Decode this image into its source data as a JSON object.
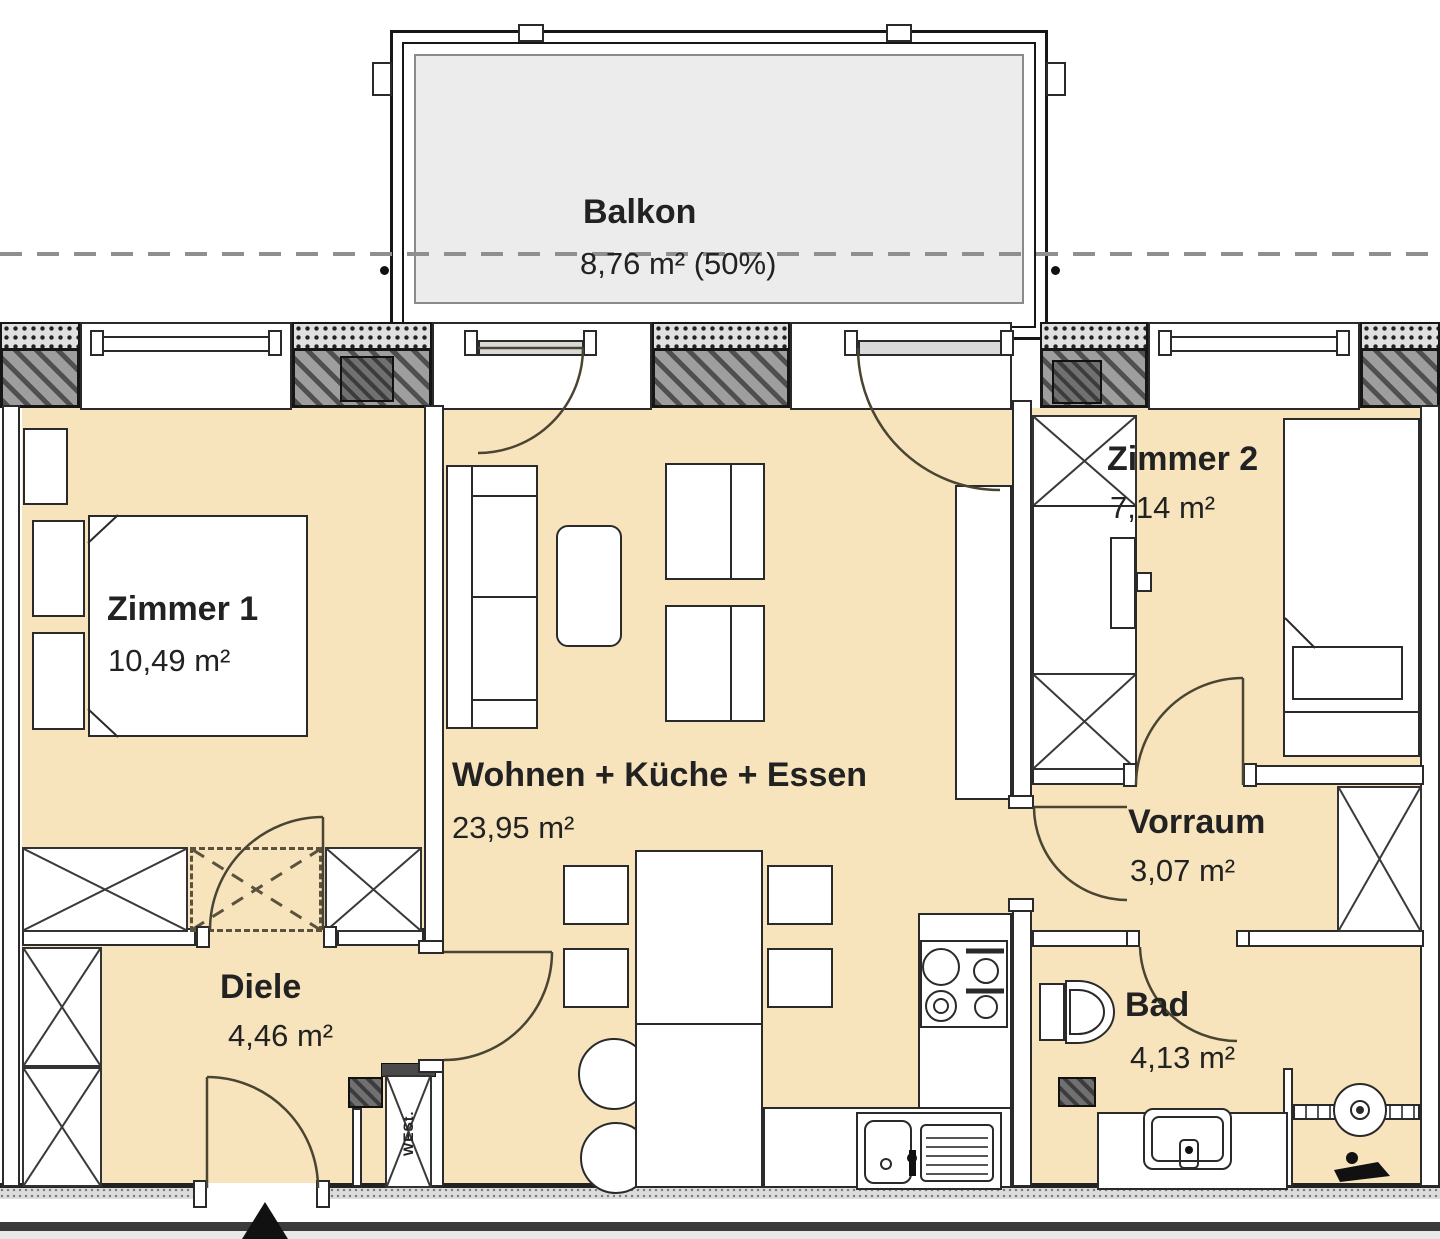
{
  "rooms": {
    "balkon": {
      "name": "Balkon",
      "area": "8,76 m² (50%)"
    },
    "zimmer1": {
      "name": "Zimmer 1",
      "area": "10,49 m²"
    },
    "wohnen": {
      "name": "Wohnen + Küche + Essen",
      "area": "23,95 m²"
    },
    "zimmer2": {
      "name": "Zimmer 2",
      "area": "7,14 m²"
    },
    "vorraum": {
      "name": "Vorraum",
      "area": "3,07 m²"
    },
    "bad": {
      "name": "Bad",
      "area": "4,13 m²"
    },
    "diele": {
      "name": "Diele",
      "area": "4,46 m²"
    }
  },
  "labels": {
    "shaft": "WESt."
  },
  "colors": {
    "floor_fill": "#F7E4BC",
    "balcony_fill": "#ECECEC",
    "wall_outline": "#222222",
    "wall_hatch_gray": "#9E9E9E",
    "door_arc": "#4A4433"
  }
}
